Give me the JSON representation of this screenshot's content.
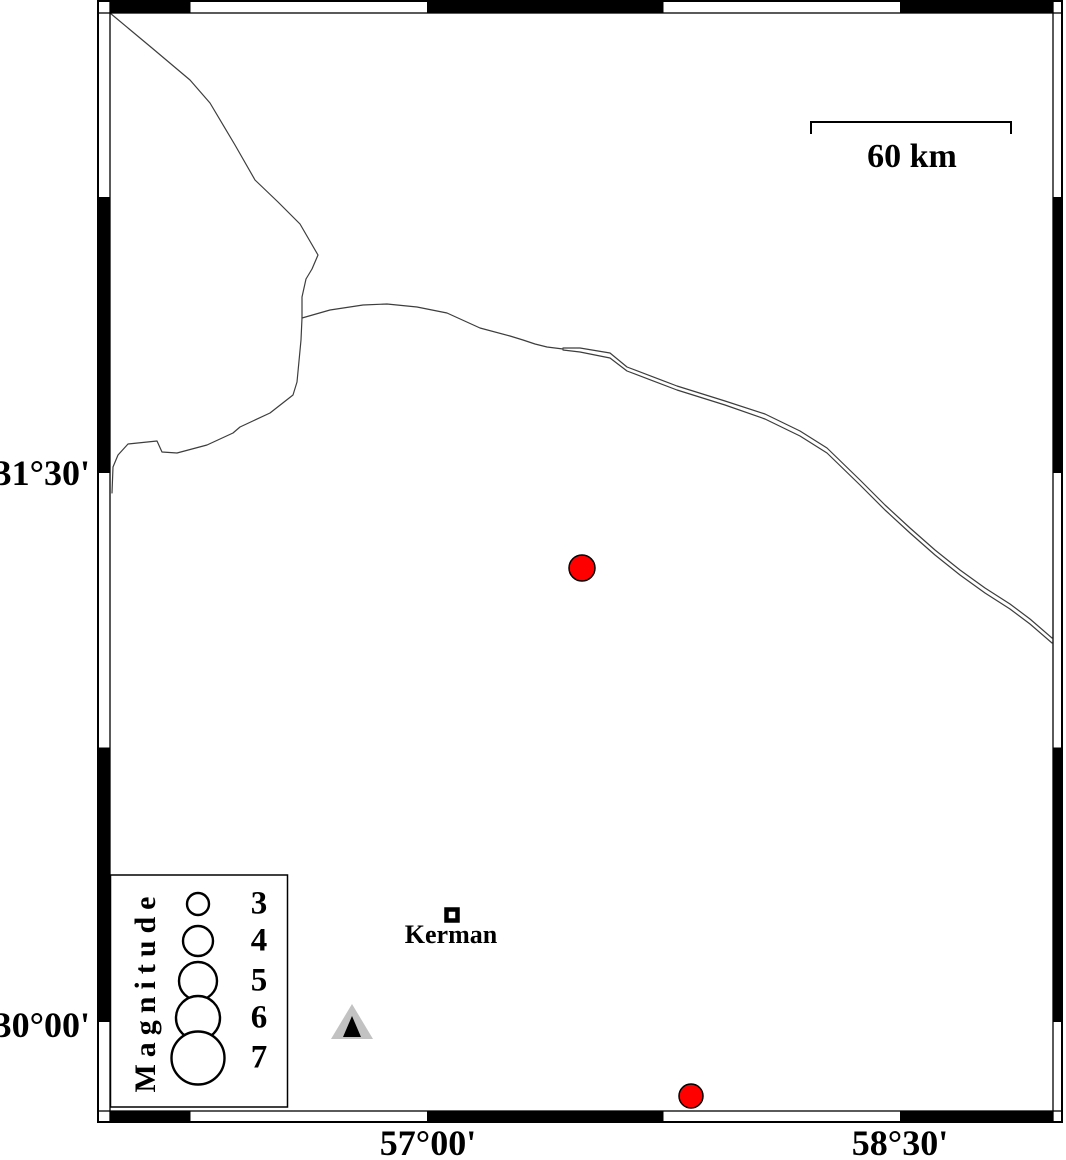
{
  "figure": {
    "description": "Seismicity map of the Kerman region (GMT-style) with fancy black/white frame",
    "background_color": "#ffffff"
  },
  "colors": {
    "frame": "#000000",
    "boundary_line": "#3d3d3d",
    "earthquake_fill": "#ff0000",
    "station_outer": "#c2c2c2",
    "station_inner": "#000000",
    "marker_outline": "#000000",
    "legend_circle_fill": "#ffffff"
  },
  "axes": {
    "lat_labels": [
      {
        "text": "31°30'",
        "y": 473
      },
      {
        "text": "30°00'",
        "y": 1022
      }
    ],
    "lon_labels": [
      {
        "text": "57°00'",
        "x": 427
      },
      {
        "text": "58°30'",
        "x": 900
      }
    ]
  },
  "frame": {
    "outer": {
      "x": 98,
      "y": 1,
      "w": 964,
      "h": 1121
    },
    "inner": {
      "x": 110,
      "y": 13,
      "w": 943,
      "h": 1098
    },
    "top_bottom_black_x": [
      [
        110,
        190.5
      ],
      [
        427,
        663.5
      ],
      [
        900,
        1053
      ]
    ],
    "left_right_black_y": [
      [
        197,
        473
      ],
      [
        747.5,
        1022
      ]
    ]
  },
  "scale_bar": {
    "label": "60 km",
    "x1": 811,
    "x2": 1011,
    "y": 122,
    "tick_drop": 12
  },
  "city": {
    "name": "Kerman",
    "x": 452,
    "y": 915,
    "marker_size": 15
  },
  "station": {
    "outer": [
      [
        352,
        1004
      ],
      [
        331,
        1039
      ],
      [
        373,
        1039
      ]
    ],
    "inner": [
      [
        352,
        1016
      ],
      [
        343,
        1037
      ],
      [
        361,
        1037
      ]
    ]
  },
  "earthquakes": [
    {
      "x": 582,
      "y": 568,
      "r": 13
    },
    {
      "x": 691,
      "y": 1096,
      "r": 12
    }
  ],
  "legend": {
    "title": "Magnitude",
    "box": {
      "x": 110.5,
      "y": 875,
      "w": 177,
      "h": 232
    },
    "circle_x": 198,
    "label_x": 259,
    "entries": [
      {
        "label": "3",
        "y": 904,
        "r": 11
      },
      {
        "label": "4",
        "y": 941,
        "r": 15
      },
      {
        "label": "5",
        "y": 981,
        "r": 19
      },
      {
        "label": "6",
        "y": 1018,
        "r": 22
      },
      {
        "label": "7",
        "y": 1058,
        "r": 26.5
      }
    ]
  },
  "boundary_lines": [
    {
      "name": "border-line-northwest",
      "points": [
        [
          110,
          13
        ],
        [
          152,
          48
        ],
        [
          190,
          80
        ],
        [
          210,
          103
        ],
        [
          235,
          145
        ],
        [
          255,
          180
        ],
        [
          278,
          202
        ],
        [
          300,
          224
        ],
        [
          318,
          255
        ],
        [
          312,
          269
        ],
        [
          306,
          279
        ],
        [
          302,
          297
        ],
        [
          302,
          318
        ],
        [
          301,
          340
        ],
        [
          299,
          361
        ],
        [
          297,
          382
        ],
        [
          293,
          395
        ],
        [
          270,
          413
        ],
        [
          240,
          427
        ],
        [
          233,
          433
        ],
        [
          207,
          445
        ],
        [
          177,
          453
        ],
        [
          162,
          452
        ],
        [
          157,
          441
        ],
        [
          128,
          444
        ],
        [
          118,
          455
        ],
        [
          113,
          467
        ],
        [
          112,
          493
        ]
      ]
    },
    {
      "name": "border-line-east-single",
      "points": [
        [
          302,
          318
        ],
        [
          330,
          310
        ],
        [
          363,
          305
        ],
        [
          387,
          304
        ],
        [
          417,
          307
        ],
        [
          447,
          313
        ],
        [
          480,
          328
        ],
        [
          510,
          336
        ],
        [
          523,
          340
        ],
        [
          535,
          344
        ],
        [
          547,
          347
        ],
        [
          563,
          349
        ]
      ]
    },
    {
      "name": "border-line-east-north",
      "points": [
        [
          563,
          348
        ],
        [
          580,
          348
        ],
        [
          610,
          353
        ],
        [
          627,
          367
        ],
        [
          677,
          386
        ],
        [
          725,
          401
        ],
        [
          765,
          414
        ],
        [
          800,
          431
        ],
        [
          827,
          448
        ],
        [
          860,
          480
        ],
        [
          885,
          505
        ],
        [
          910,
          528
        ],
        [
          935,
          550
        ],
        [
          960,
          570
        ],
        [
          985,
          588
        ],
        [
          1010,
          604
        ],
        [
          1030,
          619
        ],
        [
          1052,
          638
        ]
      ]
    },
    {
      "name": "border-line-east-south",
      "points": [
        [
          563,
          350
        ],
        [
          580,
          352
        ],
        [
          610,
          358
        ],
        [
          627,
          371
        ],
        [
          677,
          390
        ],
        [
          725,
          405
        ],
        [
          765,
          419
        ],
        [
          800,
          436
        ],
        [
          827,
          453
        ],
        [
          860,
          485
        ],
        [
          885,
          510
        ],
        [
          910,
          533
        ],
        [
          935,
          555
        ],
        [
          960,
          575
        ],
        [
          985,
          593
        ],
        [
          1010,
          609
        ],
        [
          1030,
          624
        ],
        [
          1052,
          643
        ]
      ]
    }
  ]
}
